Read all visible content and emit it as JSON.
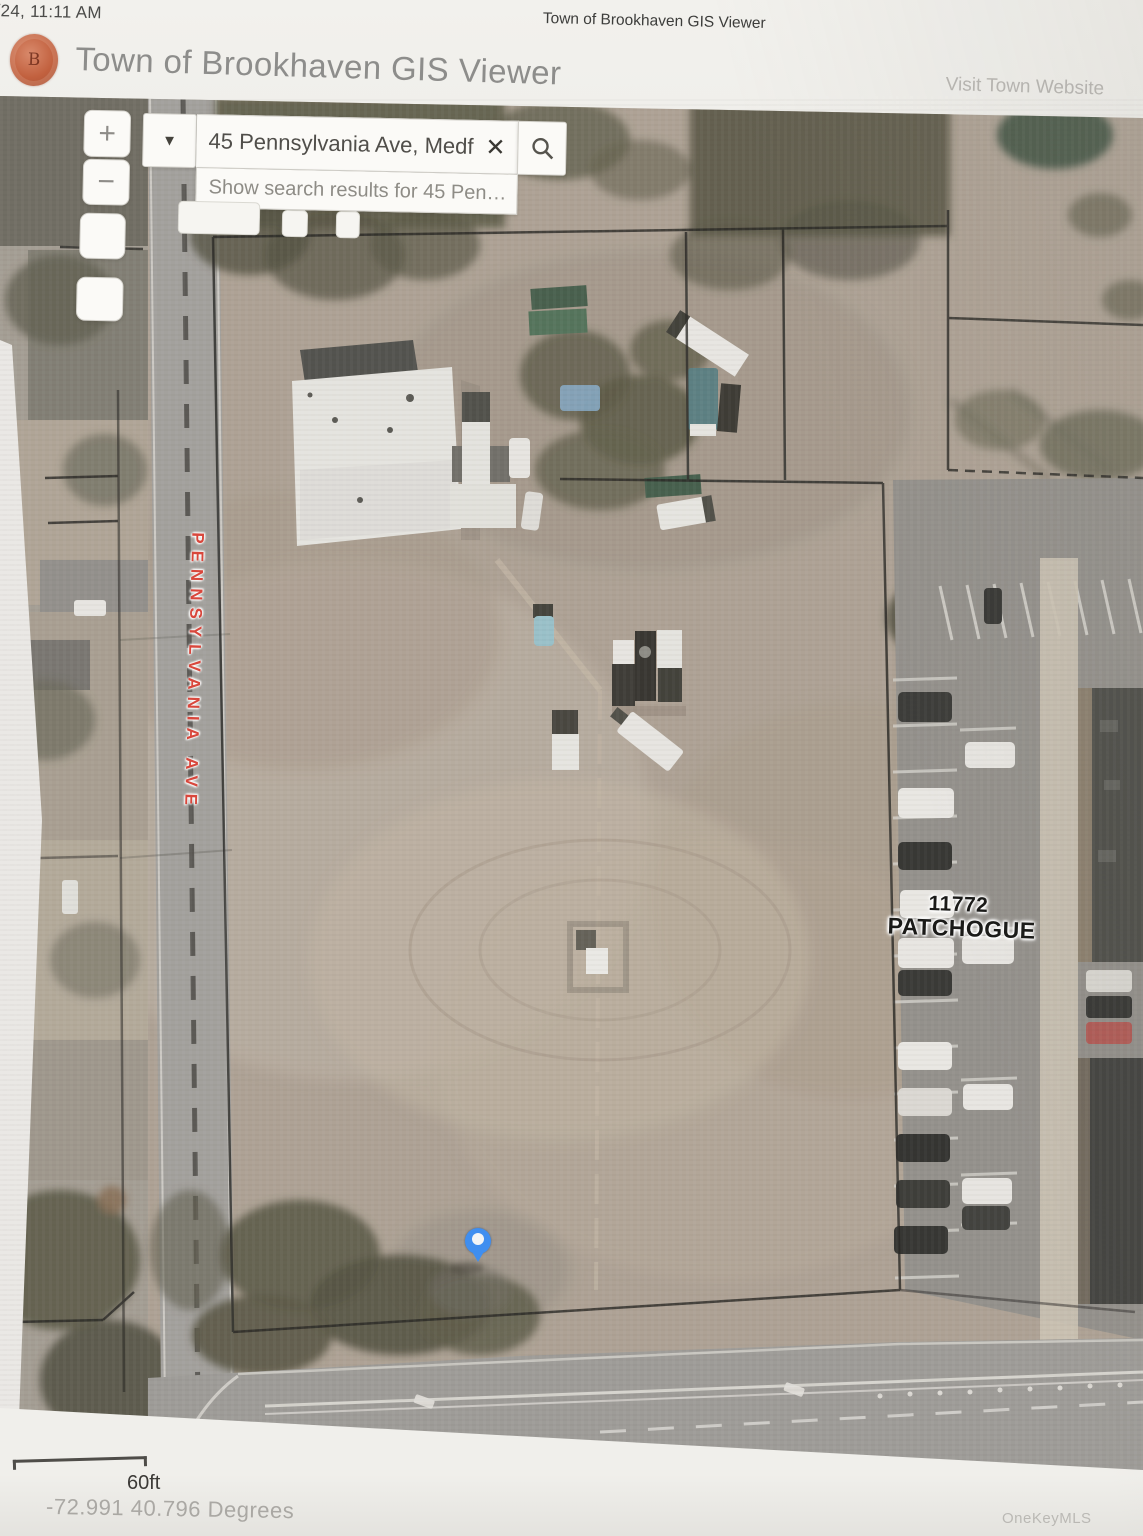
{
  "page": {
    "timestamp": "5/24, 11:11 AM",
    "print_title": "Town of Brookhaven GIS Viewer",
    "watermark": "OneKeyMLS"
  },
  "header": {
    "app_title": "Town of Brookhaven GIS Viewer",
    "seal_letter": "B",
    "link": "Visit Town Website"
  },
  "search": {
    "value": "45 Pennsylvania Ave, Medf",
    "suggestion": "Show search results for 45 Pen…",
    "icons": {
      "plus": "+",
      "minus": "−",
      "caret_down": "▼",
      "clear": "✕"
    }
  },
  "map": {
    "street_label": "PENNSYLVANIA AVE",
    "place_label_line1": "11772",
    "place_label_line2": "PATCHOGUE",
    "colors": {
      "marker": "#3f8ef0",
      "street_label": "#d8473c",
      "place_label": "#1a1a18",
      "seal": "#c2613f",
      "dirt_lot": "#ae9f8e",
      "parcel_line": "#1f1d1a"
    }
  },
  "footer": {
    "scale_label": "60ft",
    "coordinates": "-72.991 40.796 Degrees"
  }
}
